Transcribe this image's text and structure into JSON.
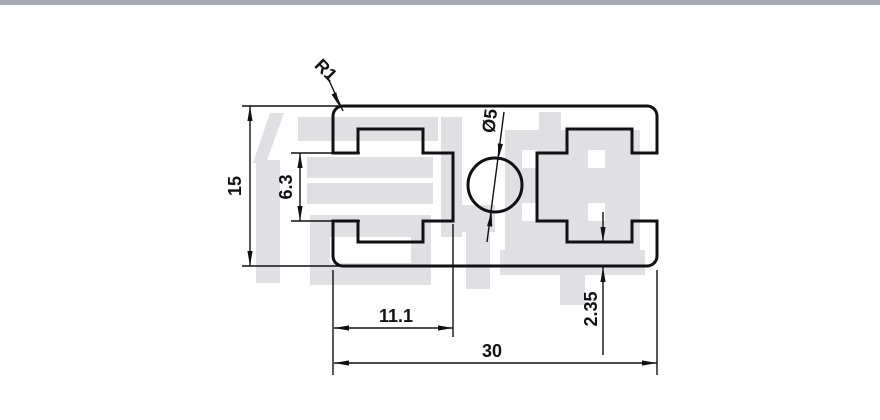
{
  "window": {
    "top_bar_color": "#a9aab3",
    "background": "#ffffff"
  },
  "watermark": {
    "text": "信牌",
    "color": "#e0e0e2"
  },
  "drawing": {
    "type": "technical-drawing",
    "subject": "aluminum extrusion profile cross-section",
    "line_color": "#111111",
    "labels": {
      "overall_height": "15",
      "slot_opening_height": "6.3",
      "corner_radius": "R1",
      "center_hole_diameter": "Ø5",
      "slot_depth": "11.1",
      "overall_width": "30",
      "bottom_wall_thickness": "2.35"
    }
  }
}
